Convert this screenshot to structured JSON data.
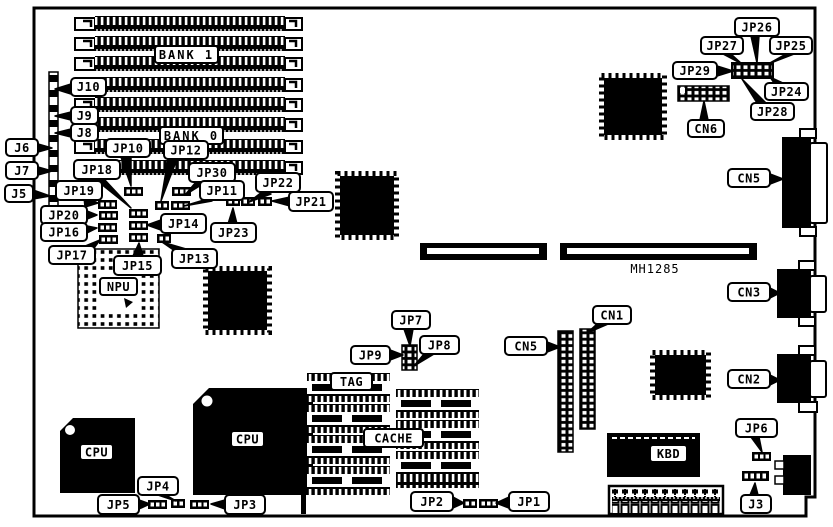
{
  "diagram": {
    "part_number": "MH1285",
    "labels": {
      "j3": "J3",
      "j5": "J5",
      "j6": "J6",
      "j7": "J7",
      "j8": "J8",
      "j9": "J9",
      "j10": "J10",
      "jp1": "JP1",
      "jp2": "JP2",
      "jp3": "JP3",
      "jp4": "JP4",
      "jp5": "JP5",
      "jp6": "JP6",
      "jp7": "JP7",
      "jp8": "JP8",
      "jp9": "JP9",
      "jp10": "JP10",
      "jp11": "JP11",
      "jp12": "JP12",
      "jp13": "JP13",
      "jp14": "JP14",
      "jp15": "JP15",
      "jp16": "JP16",
      "jp17": "JP17",
      "jp18": "JP18",
      "jp19": "JP19",
      "jp20": "JP20",
      "jp21": "JP21",
      "jp22": "JP22",
      "jp23": "JP23",
      "jp24": "JP24",
      "jp25": "JP25",
      "jp26": "JP26",
      "jp27": "JP27",
      "jp28": "JP28",
      "jp29": "JP29",
      "jp30": "JP30",
      "cn1": "CN1",
      "cn2": "CN2",
      "cn3": "CN3",
      "cn5_center": "CN5",
      "cn5_right": "CN5",
      "cn6": "CN6",
      "bank0": "BANK 0",
      "bank1": "BANK 1",
      "npu": "NPU",
      "cpu_small": "CPU",
      "cpu_large": "CPU",
      "tag": "TAG",
      "cache": "CACHE",
      "kbd": "KBD"
    },
    "colors": {
      "ink": "#000000",
      "paper": "#ffffff"
    }
  }
}
